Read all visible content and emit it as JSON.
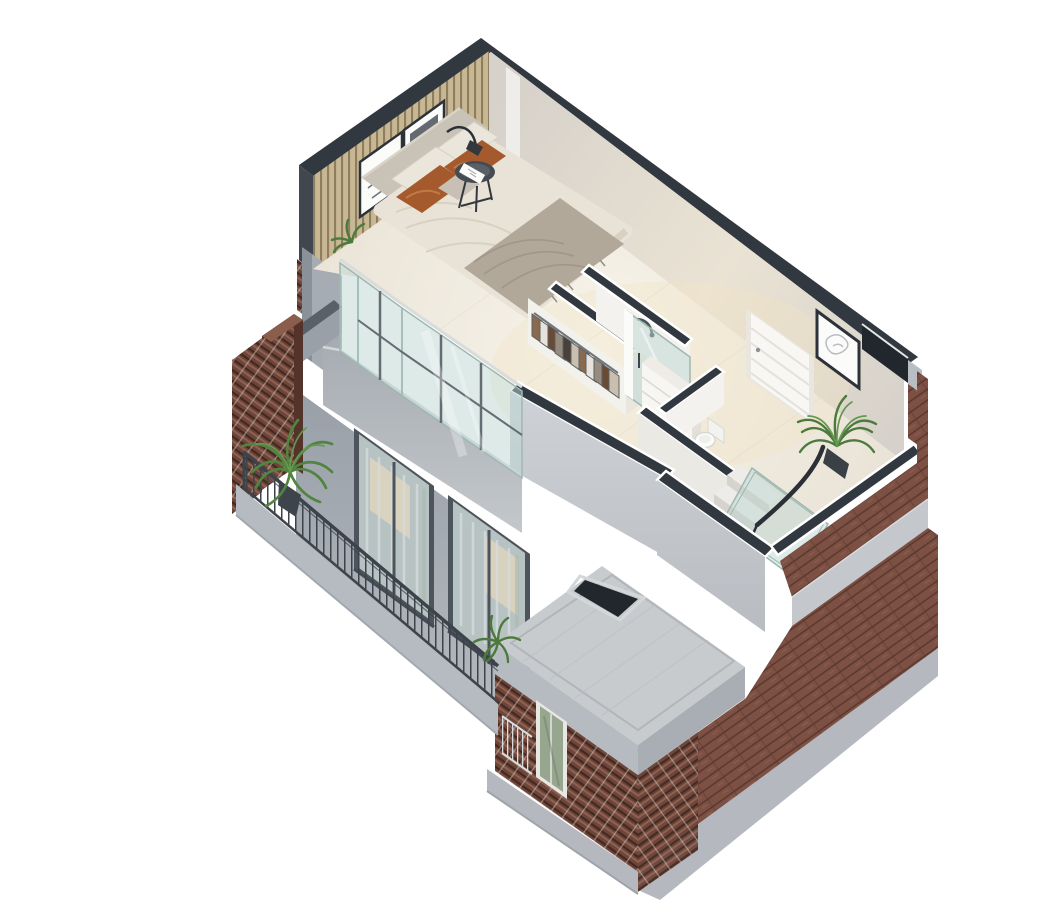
{
  "scene": {
    "title": "Isometric 3D cutaway floor plan render of a two-level loft apartment with bedroom, bathroom, stairs, brick facade and planted balcony",
    "type": "architectural-isometric-cutaway-render",
    "background": "#ffffff",
    "palette": {
      "bg": "#ffffff",
      "cut": "#32383f",
      "void": "#22272d",
      "wall_ne": "#d6d1ca",
      "wall_ne_warm": "#eae3d4",
      "wall_trim": "#efede9",
      "wall_white": "#f4f2ee",
      "slat_base": "#c8b793",
      "slat_gap": "#8e7e5f",
      "floor_hi": "#f7f3e9",
      "floor_lo": "#e9e3d6",
      "glow": "#f3e3c2",
      "headboard": "#c9c2b6",
      "duvet": "#e9e3d7",
      "duvet_fold": "#d6cfc1",
      "throw": "#b2a89a",
      "throw_dark": "#978d7e",
      "pillow_white": "#ebe6db",
      "pillow_rust": "#a55a2e",
      "pillow_rust_hi": "#c27a43",
      "table_dark": "#454b52",
      "metal": "#2b3036",
      "green": "#4c7a3c",
      "green_dark": "#3a652e",
      "green_light": "#659850",
      "palm": "#52833f",
      "cloth_a": "#8a6a4f",
      "cloth_b": "#e7e3dc",
      "cloth_c": "#6b4a33",
      "cloth_d": "#968c7e",
      "cloth_e": "#4a4038",
      "cloth_f": "#cabfae",
      "rail": "#3d434a",
      "rail_light": "#dadddf",
      "brick": "#7d5044",
      "brick_dark": "#5c392f",
      "brick_hi": "#96685a",
      "brick_deep": "#6d453a",
      "lat_hi": "#8f6150",
      "lat_dark": "#43291f",
      "lat_slit": "#d9d0c7",
      "concrete_band": "#c4c8cc",
      "terrace": "#c8cbce",
      "terrace_line": "#b2b5b9",
      "fascia": "#b6bbc1",
      "fascia_dark": "#a9aeb5",
      "plinth": "#b5b9bf",
      "facade_top": "#99a0a8",
      "facade_bot": "#b4b9bf",
      "ledge_top": "#a8adb3",
      "ledge_bot": "#c4c8cb",
      "pier": "#a6acb4",
      "pier_edge": "#8a9199",
      "parapet_top": "#596067",
      "win_frame": "#4e545b",
      "win_glass": "#b7c2c3",
      "curtain": "#d6dbdc",
      "win_warm": "#ded5bd",
      "win_green": "#a9bcae",
      "glass_tint": "#bcd6d1",
      "glass_edge": "#9fb7b1",
      "door": "#f8f7f4",
      "door_frame": "#e9e6e0",
      "door_line": "#e4e1db",
      "porcelain": "#fbfbfa",
      "porcelain_line": "#d8d8d3",
      "vanity": "#f7f6f3",
      "vanity_line": "#ddd8d1",
      "alcove": "#f3f1ec",
      "step": "#edece8",
      "riser": "#d6d3cd",
      "art_sketch": "#b9bcc1",
      "art_dark": "#4a5058",
      "box_window_glass": "#97a68f"
    },
    "upper_floor": {
      "rooms": [
        {
          "name": "bedroom",
          "items": [
            "double-bed",
            "upholstered-headboard",
            "white-bedding",
            "rust-accent-pillows",
            "gray-throw-blanket",
            "wood-slat-accent-wall",
            "framed-artwork-left",
            "framed-artwork-right",
            "round-side-table",
            "arc-floor-lamp",
            "bedside-greenery",
            "corner-bay-window"
          ]
        },
        {
          "name": "walk-in-closet",
          "items": [
            "clothes-rail",
            "hanging-clothes"
          ]
        },
        {
          "name": "shower-room",
          "items": [
            "glass-shower-door",
            "wall-shower-mixer",
            "white-vanity-drawers"
          ]
        },
        {
          "name": "wc",
          "items": [
            "toilet"
          ]
        },
        {
          "name": "hallway",
          "items": [
            "white-paneled-door",
            "framed-artwork",
            "potted-plant",
            "staircase-down",
            "glass-balustrade",
            "dark-handrail",
            "corner-shaft-void"
          ]
        }
      ]
    },
    "exterior": {
      "materials": [
        "red-brick",
        "gray-concrete",
        "glass",
        "dark-metal"
      ],
      "items": [
        "east-brick-facade",
        "concrete-string-course",
        "roof-terrace-slab",
        "terrace-stair-void",
        "southwest-concrete-facade",
        "floor-to-ceiling-window-1",
        "floor-to-ceiling-window-2",
        "sheer-curtains",
        "floor-slab-ledge",
        "balcony-metal-railing",
        "perforated-brick-screen-panels",
        "palm-plant-in-pot",
        "terrace-fern",
        "lower-brick-volume",
        "brick-lattice-corner",
        "narrow-window",
        "juliet-railing",
        "concrete-plinth"
      ]
    }
  }
}
